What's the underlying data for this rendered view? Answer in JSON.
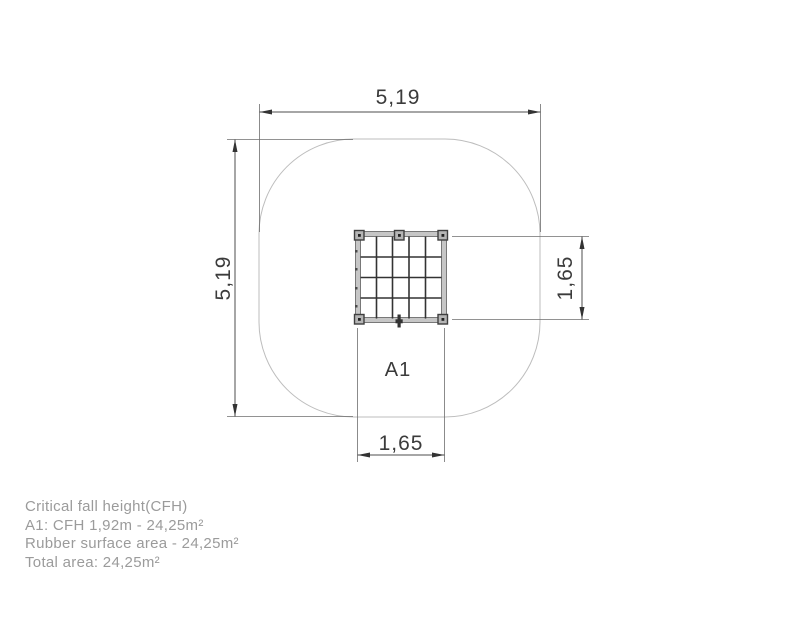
{
  "drawing": {
    "dimensions": {
      "overall_width": "5,19",
      "overall_height": "5,19",
      "item_height": "1,65",
      "item_width": "1,65"
    },
    "area_label": "A1"
  },
  "notes": {
    "lines": [
      "Critical fall height(CFH)",
      "A1: CFH 1,92m - 24,25m²",
      "Rubber surface area - 24,25m²",
      "Total area: 24,25m²"
    ]
  },
  "colors": {
    "dimension_lines": "#4d4d4d",
    "dimension_text": "#3b3b3b",
    "safety_area_outline": "#bdbdbd",
    "net_frame": "#c6c6c6",
    "net_frame_edge": "#787878",
    "net_wire": "#333333",
    "notes_text": "#9b9b9b",
    "background": "#ffffff"
  }
}
